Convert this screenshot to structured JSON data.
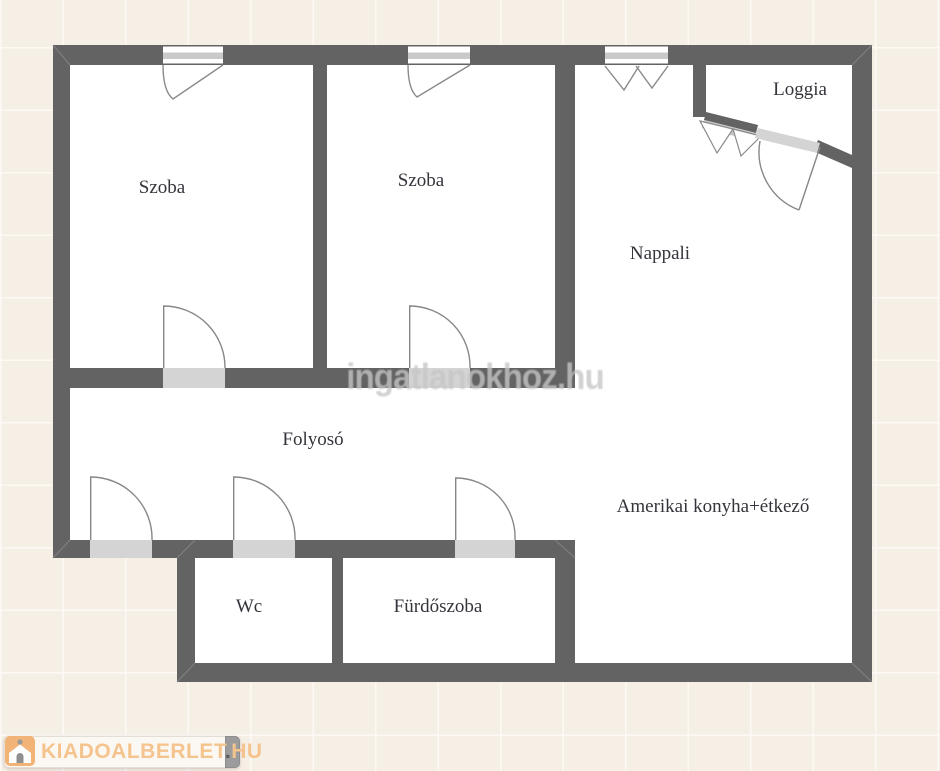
{
  "rooms": {
    "szoba1": {
      "label": "Szoba"
    },
    "szoba2": {
      "label": "Szoba"
    },
    "nappali": {
      "label": "Nappali"
    },
    "loggia": {
      "label": "Loggia"
    },
    "folyoso": {
      "label": "Folyosó"
    },
    "wc": {
      "label": "Wc"
    },
    "furdoszoba": {
      "label": "Fürdőszoba"
    },
    "konyha_etkezo": {
      "label": "Amerikai konyha+étkező"
    }
  },
  "watermarks": {
    "center_text": "ingatlanokhoz.hu",
    "logo": {
      "brand": "KIADOALBERLET",
      "dot": ".",
      "tld": "HU"
    }
  },
  "colors": {
    "wall": "#636363",
    "door_threshold": "#d4d4d4",
    "window_band": "#c9c9c9",
    "floor": "#ffffff",
    "background": "#f6efe6",
    "label_text": "#34343c",
    "brand_orange": "#f2b377",
    "brand_text": "#f5c48e"
  }
}
